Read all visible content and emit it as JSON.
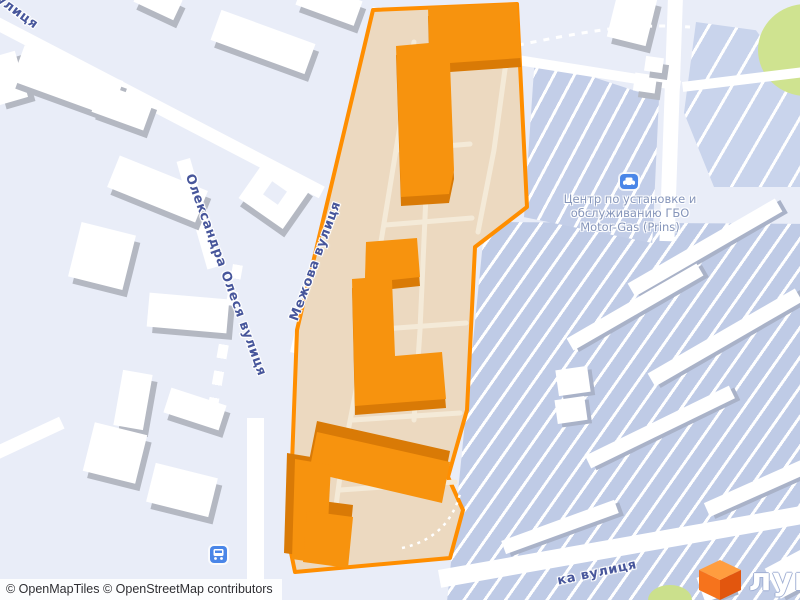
{
  "streets": {
    "olesya": "Олександра Олеся вулиця",
    "mezhova": "Межова вулиця",
    "top_left_fragment": "улиця",
    "bottom_right_fragment": "ка вулиця"
  },
  "poi": {
    "lines": [
      "Центр по установке и",
      "обслуживанию ГБО",
      "Motor-Gas (Prins)"
    ],
    "icon": "car-service-icon"
  },
  "transit": {
    "icon": "bus-icon"
  },
  "attribution": {
    "text": "© OpenMapTiles © OpenStreetMap contributors"
  },
  "logo": {
    "text": "лун",
    "icon": "lun-cube-icon"
  },
  "highlight": {
    "fill": "#ecd9c0",
    "stroke": "#ff8e00",
    "building_top": "#f7930e",
    "building_side": "#d97a06"
  },
  "map_colors": {
    "background": "#e9edf8",
    "garage_fill": "#bfcbe6",
    "road": "#ffffff",
    "building_white": "#ffffff",
    "building_shadow": "#b4b8c2",
    "green_area": "#cfe390",
    "street_label": "#47569b",
    "poi_label": "#8595ba",
    "transit_icon": "#4a86e8"
  }
}
